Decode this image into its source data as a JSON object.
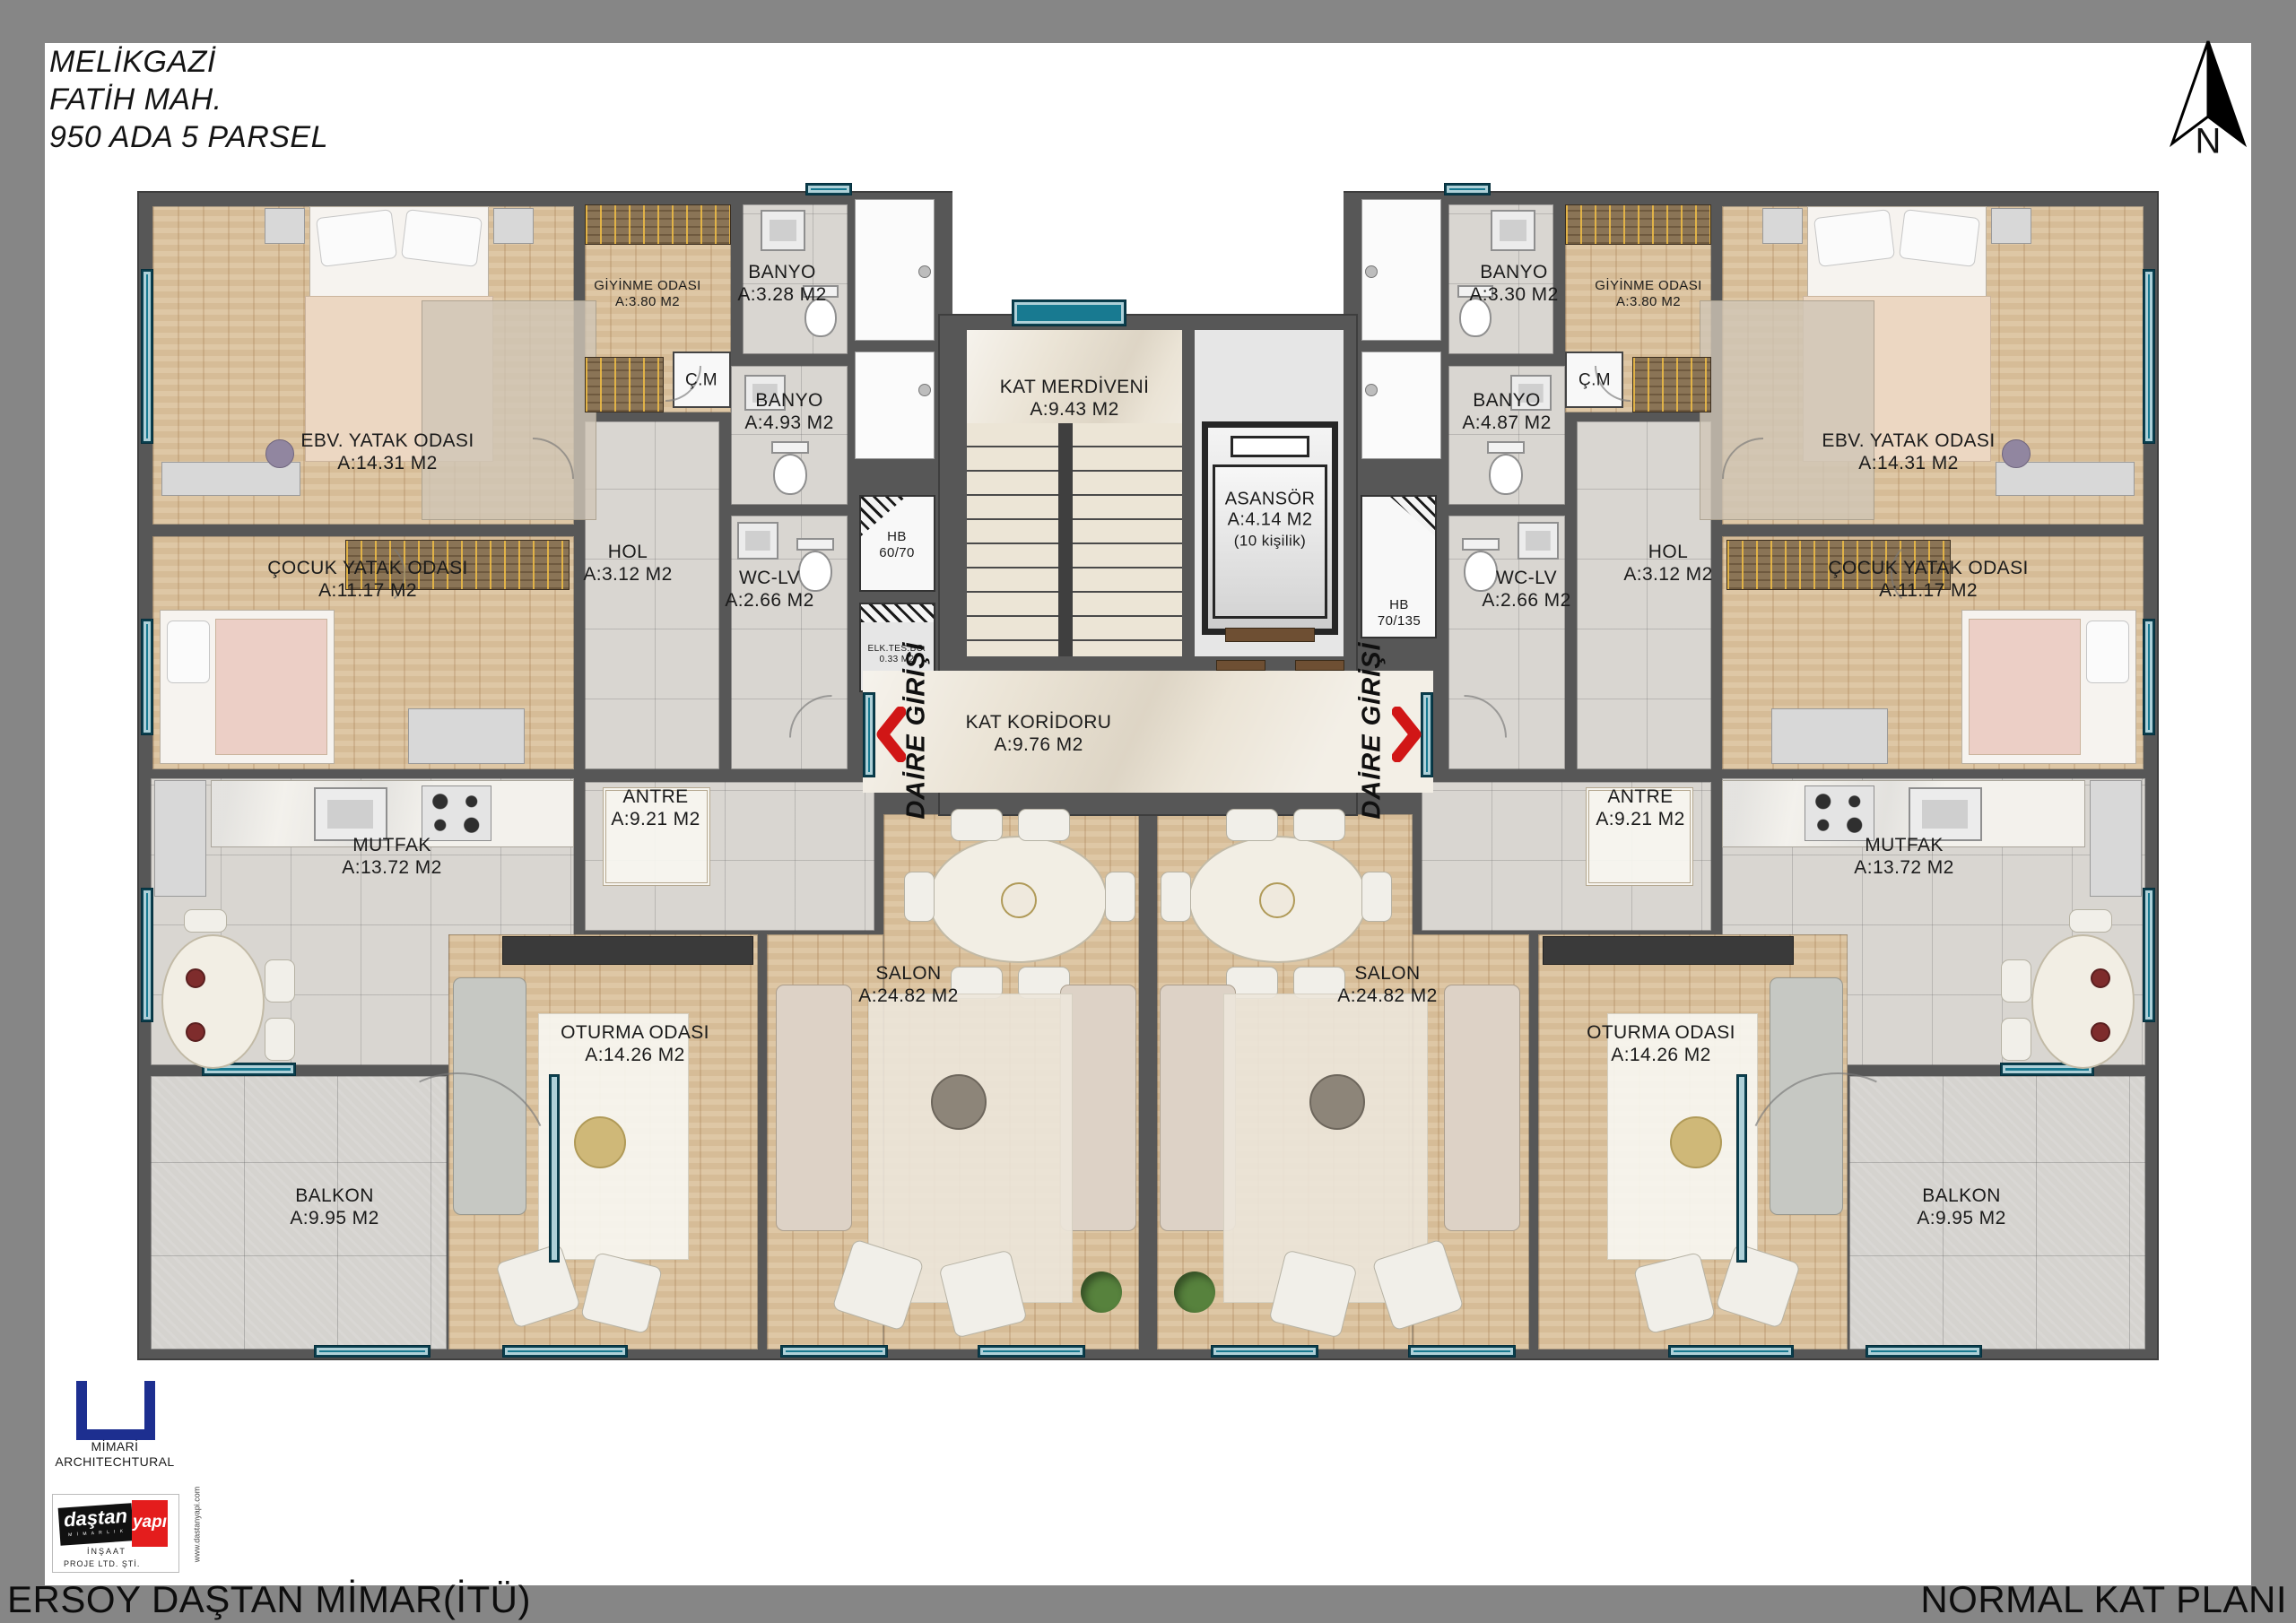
{
  "page": {
    "title_lines": [
      "MELİKGAZİ",
      "FATİH MAH.",
      "950 ADA 5 PARSEL"
    ],
    "footer_left": "ERSOY DAŞTAN MİMAR(İTÜ)",
    "footer_right": "NORMAL KAT PLANI",
    "north_label": "N"
  },
  "colors": {
    "window_teal": "#187a91",
    "arrow_red": "#d11616",
    "wall_gray": "#575757",
    "logo_blue": "#1d2f90",
    "logo_red": "#e41d1d"
  },
  "core": {
    "stairs": {
      "name": "KAT MERDİVENİ",
      "area": "A:9.43 M2"
    },
    "elevator": {
      "name": "ASANSÖR",
      "area": "A:4.14 M2",
      "capacity": "(10 kişilik)"
    },
    "corridor": {
      "name": "KAT KORİDORU",
      "area": "A:9.76 M2"
    },
    "entrance": "DAİRE GİRİŞİ",
    "shaft_hb_left": {
      "l1": "HB",
      "l2": "60/70"
    },
    "shaft_hb_right": {
      "l1": "HB",
      "l2": "70/135"
    },
    "shaft_elk": {
      "l1": "ELK.TES.BC.",
      "l2": "0.33 M2"
    }
  },
  "left": {
    "master": {
      "name": "EBV. YATAK ODASI",
      "area": "A:14.31 M2"
    },
    "child": {
      "name": "ÇOCUK YATAK ODASI",
      "area": "A:11.17 M2"
    },
    "dressing": {
      "name": "GİYİNME ODASI",
      "area": "A:3.80 M2"
    },
    "bath1": {
      "name": "BANYO",
      "area": "A:3.28 M2"
    },
    "bath2": {
      "name": "BANYO",
      "area": "A:4.93 M2"
    },
    "cm": {
      "name": "Ç.M"
    },
    "hall": {
      "name": "HOL",
      "area": "A:3.12 M2"
    },
    "wc": {
      "name": "WC-LV",
      "area": "A:2.66 M2"
    },
    "kitchen": {
      "name": "MUTFAK",
      "area": "A:13.72 M2"
    },
    "entry": {
      "name": "ANTRE",
      "area": "A:9.21 M2"
    },
    "living": {
      "name": "OTURMA ODASI",
      "area": "A:14.26 M2"
    },
    "salon": {
      "name": "SALON",
      "area": "A:24.82 M2"
    },
    "balcony": {
      "name": "BALKON",
      "area": "A:9.95 M2"
    }
  },
  "right": {
    "master": {
      "name": "EBV. YATAK ODASI",
      "area": "A:14.31 M2"
    },
    "child": {
      "name": "ÇOCUK YATAK ODASI",
      "area": "A:11.17 M2"
    },
    "dressing": {
      "name": "GİYİNME ODASI",
      "area": "A:3.80 M2"
    },
    "bath1": {
      "name": "BANYO",
      "area": "A:3.30 M2"
    },
    "bath2": {
      "name": "BANYO",
      "area": "A:4.87 M2"
    },
    "cm": {
      "name": "Ç.M"
    },
    "hall": {
      "name": "HOL",
      "area": "A:3.12 M2"
    },
    "wc": {
      "name": "WC-LV",
      "area": "A:2.66 M2"
    },
    "kitchen": {
      "name": "MUTFAK",
      "area": "A:13.72 M2"
    },
    "entry": {
      "name": "ANTRE",
      "area": "A:9.21 M2"
    },
    "living": {
      "name": "OTURMA ODASI",
      "area": "A:14.26 M2"
    },
    "salon": {
      "name": "SALON",
      "area": "A:24.82 M2"
    },
    "balcony": {
      "name": "BALKON",
      "area": "A:9.95 M2"
    }
  },
  "logos": {
    "mimari": {
      "l1": "MİMARİ",
      "l2": "ARCHITECHTURAL"
    },
    "dastan": {
      "black": "daştan",
      "red": "yapı",
      "sub": "M İ M A R L I K",
      "line1": "İNŞAAT",
      "line2": "PROJE LTD. ŞTİ.",
      "web": "www.dastanyapi.com"
    }
  }
}
